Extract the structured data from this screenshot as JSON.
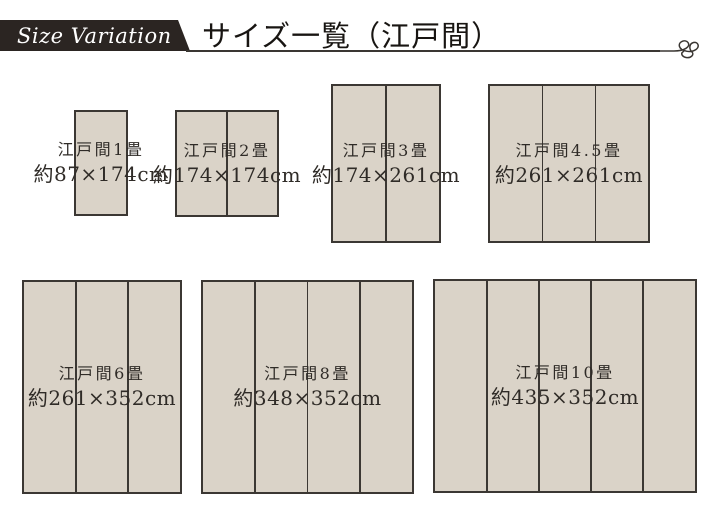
{
  "header": {
    "ribbon_label": "Size Variation",
    "title": "サイズ一覧（江戸間）"
  },
  "style": {
    "ribbon_color": "#2b2522",
    "line_color": "#3a3632",
    "mat_fill": "#dad3c8",
    "mat_border": "#3b3733",
    "label_color": "#2f2b27"
  },
  "mats": [
    {
      "name": "江戸間1畳",
      "size": "約87×174cm",
      "panels": 1,
      "x": 74,
      "y": 110,
      "w": 54,
      "h": 106
    },
    {
      "name": "江戸間2畳",
      "size": "約174×174cm",
      "panels": 2,
      "x": 175,
      "y": 110,
      "w": 104,
      "h": 107
    },
    {
      "name": "江戸間3畳",
      "size": "約174×261cm",
      "panels": 2,
      "x": 331,
      "y": 84,
      "w": 110,
      "h": 159
    },
    {
      "name": "江戸間4.5畳",
      "size": "約261×261cm",
      "panels": 3,
      "x": 488,
      "y": 84,
      "w": 162,
      "h": 159
    },
    {
      "name": "江戸間6畳",
      "size": "約261×352cm",
      "panels": 3,
      "x": 22,
      "y": 280,
      "w": 160,
      "h": 214
    },
    {
      "name": "江戸間8畳",
      "size": "約348×352cm",
      "panels": 4,
      "x": 201,
      "y": 280,
      "w": 213,
      "h": 214
    },
    {
      "name": "江戸間10畳",
      "size": "約435×352cm",
      "panels": 5,
      "x": 433,
      "y": 279,
      "w": 264,
      "h": 214
    }
  ]
}
